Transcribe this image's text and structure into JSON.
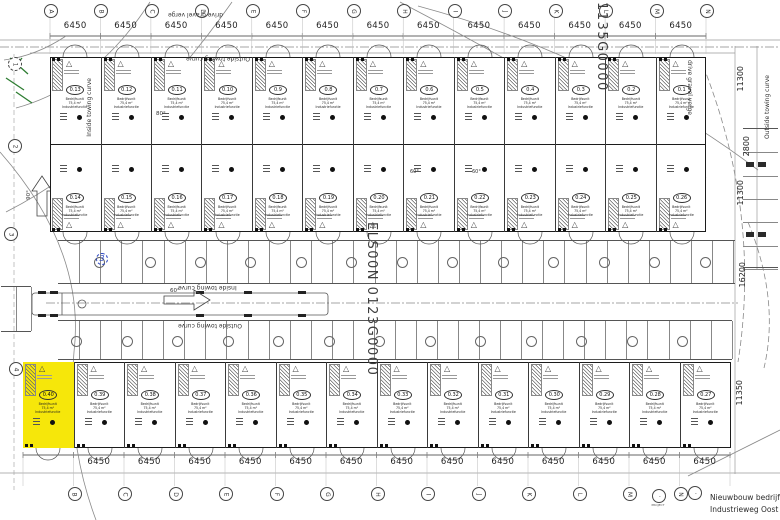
{
  "drawing": {
    "title_line1": "Nieuwbouw bedrijfsunit",
    "title_line2": "Industrieweg Oost te E",
    "project_label": "PROJECT",
    "watermark_top": "1135G0000",
    "watermark_center": "ELS00N 0123G0000",
    "revision": "3"
  },
  "grid": {
    "top_letters": [
      "A",
      "B",
      "C",
      "D",
      "E",
      "F",
      "G",
      "H",
      "I",
      "J",
      "K",
      "L",
      "M",
      "N"
    ],
    "bottom_letters": [
      "B",
      "C",
      "D",
      "E",
      "F",
      "G",
      "H",
      "I",
      "J",
      "K",
      "L",
      "M",
      "N"
    ],
    "left_numbers": [
      "1",
      "2",
      "3",
      "4"
    ]
  },
  "dimensions": {
    "bay_width": "6450",
    "right_side": [
      "11300",
      "2800",
      "11300",
      "16200",
      "11350"
    ],
    "angle_top": "80°",
    "angle_mid": "60°",
    "angle_left": "90°",
    "angle_small": "60°"
  },
  "streets": {
    "top": "drive gravel verge",
    "top_curve": "Outside towing curve",
    "mid_inside": "Inside towing curve",
    "mid_outside": "Outside towing curve",
    "left": "Inside towing curve",
    "right1": "drive gravel verge",
    "right2": "Outside towing curve"
  },
  "units": {
    "row1": [
      "0.13",
      "0.12",
      "0.11",
      "0.10",
      "0.9",
      "0.8",
      "0.7",
      "0.6",
      "0.5",
      "0.4",
      "0.3",
      "0.2",
      "0.1"
    ],
    "row2": [
      "0.14",
      "0.15",
      "0.16",
      "0.17",
      "0.18",
      "0.19",
      "0.20",
      "0.21",
      "0.22",
      "0.23",
      "0.24",
      "0.25",
      "0.26"
    ],
    "row3": [
      "0.40",
      "0.39",
      "0.38",
      "0.37",
      "0.36",
      "0.35",
      "0.34",
      "0.33",
      "0.32",
      "0.31",
      "0.30",
      "0.29",
      "0.28",
      "0.27"
    ],
    "info_lines": [
      "Bedrijfsunit",
      "75,4 m²",
      "Industriefunctie"
    ],
    "highlighted": "0.40"
  },
  "colors": {
    "highlight": "#f6e70a",
    "line": "#2b2b2b",
    "revision_red": "#cc2222",
    "revision_blue": "#2b46c0",
    "landscape_green": "#2e7d32"
  }
}
